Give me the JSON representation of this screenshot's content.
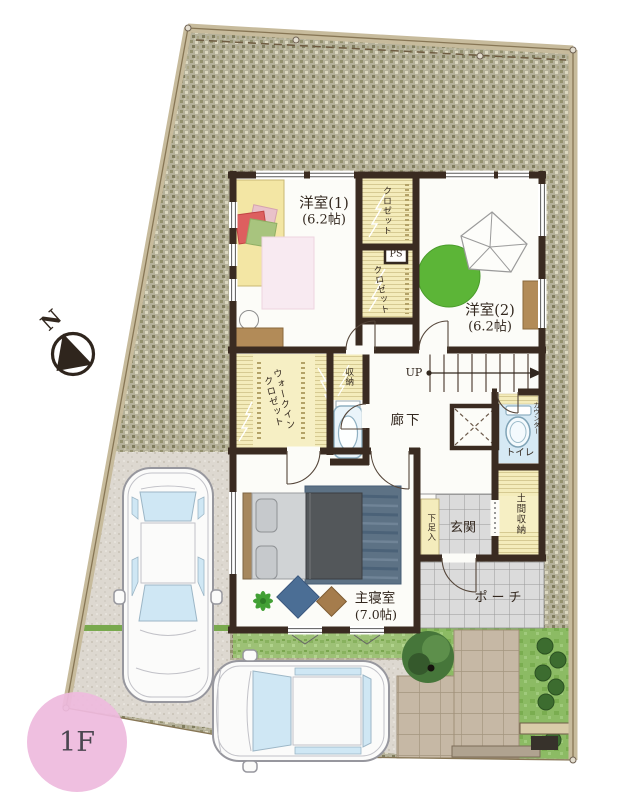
{
  "floor_plan": {
    "floor_label": "1F",
    "compass": "N",
    "rooms": [
      {
        "id": "western-room-1",
        "name": "洋室(1)",
        "size": "(6.2帖)"
      },
      {
        "id": "western-room-2",
        "name": "洋室(2)",
        "size": "(6.2帖)"
      },
      {
        "id": "master-bedroom",
        "name": "主寝室",
        "size": "(7.0帖)"
      },
      {
        "id": "hallway",
        "name": "廊下"
      },
      {
        "id": "entrance",
        "name": "玄関"
      },
      {
        "id": "porch",
        "name": "ポーチ"
      },
      {
        "id": "toilet",
        "name": "トイレ"
      },
      {
        "id": "doma-storage",
        "name": "土間収納"
      }
    ],
    "labels": {
      "up": "UP",
      "ps": "PS",
      "counter": "カウンター",
      "shoe_cabinet": "下足入",
      "storage": "収納",
      "closet_upper": "クロゼット",
      "closet_lower": "クロゼット",
      "wic_line1": "ウォークイン",
      "wic_line2": "クロゼット"
    },
    "colors": {
      "wall": "#3a2b21",
      "gravel": "#b5b19a",
      "driveway": "#ddd8d0",
      "lawn": "#8cbb64",
      "grass_strip": "#79a94e",
      "closet_fill": "#f4ecbb",
      "toilet_floor": "#d6e9f4",
      "tile_gray": "#dbdbdb",
      "paver_brown": "#c6b8a5",
      "badge_pink": "#eebade",
      "rug_circle_green": "#5cb537",
      "navy_rug": "#5d7285",
      "bed_yellow": "#f3e6a4",
      "wood_brown": "#b28b58"
    }
  }
}
